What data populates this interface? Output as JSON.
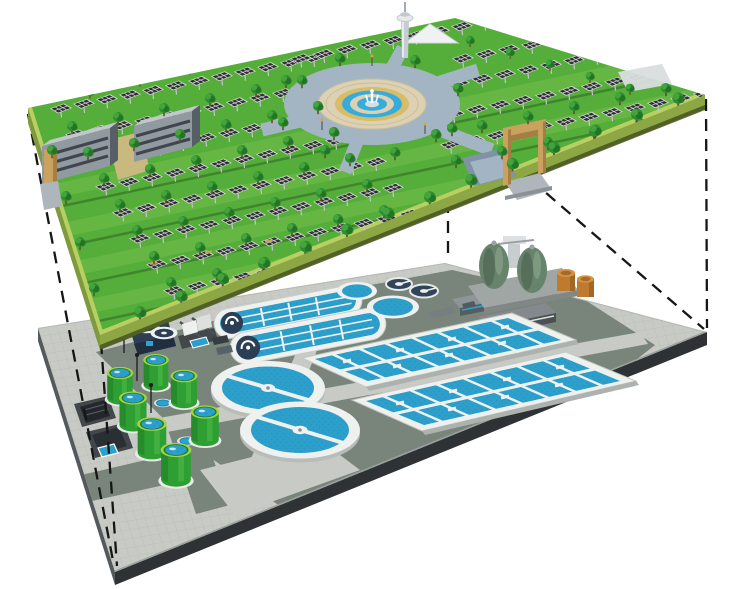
{
  "title": "Cutaway rendering: solar-panel park on the surface deck with an underground wastewater treatment plant below, linked by dashed projection lines",
  "upper_level": {
    "name": "surface park deck",
    "features": [
      "solar panel rows",
      "tree rows",
      "two office buildings",
      "central fountain plaza",
      "observation tower",
      "white pyramid pavilion",
      "tan entrance portal with ramp",
      "tan side pillar",
      "perimeter walkway band"
    ],
    "solar_panel_rows": 14,
    "buildings": 2
  },
  "lower_level": {
    "name": "underground treatment plant deck",
    "features": [
      "two circular clarifiers with bridges",
      "two aeration basin blocks",
      "two oxidation ditch racetracks",
      "two sludge digester eggs",
      "green sludge tanks",
      "two orange tanks",
      "blue blower building",
      "screening skid",
      "red pump unit",
      "service buildings",
      "open pits",
      "paved roads"
    ],
    "circular_clarifiers": 2,
    "aeration_basins": 2,
    "oxidation_ditches": 2,
    "digester_eggs": 2,
    "green_tanks": 7,
    "orange_tanks": 2
  },
  "connectors": {
    "style": "dashed",
    "count": 5,
    "color": "#161616"
  },
  "colors": {
    "bg": "#ffffff",
    "grass": "#55AE3A",
    "grassLight": "#7CC153",
    "deckSide": "#8CA743",
    "deckSideL": "#7E9A3C",
    "deckSideTop": "#B9CF61",
    "deckShadow": "#46541F",
    "tree": "#2F8C31",
    "treeDark": "#1F6E22",
    "treeLight": "#46A83F",
    "trunk": "#6B4A2A",
    "panelDark": "#2E3134",
    "panelFrame": "#DBDBD8",
    "post": "#C4C6C8",
    "building": "#9199A1",
    "buildingDark": "#565E66",
    "buildingRoof": "#C2C7CC",
    "buildingBand": "#3F464D",
    "courtyard": "#C9B97E",
    "portalTan": "#C9A25F",
    "portalTanDark": "#A57F42",
    "plazaPave": "#A3B5C2",
    "plazaDisc": "#DCD1B2",
    "plazaTan": "#D8BC6A",
    "plazaBlue": "#36ACDC",
    "towerGray": "#C6CDD2",
    "pavement": "#C8CBC5",
    "road": "#79847B",
    "deckEdgeDark": "#2E3234",
    "deckEdgeMid": "#53595C",
    "walkWhite": "#EFF1EF",
    "water": "#2D9FCB",
    "waterDark": "#1F86B4",
    "tankGreen": "#2E9F33",
    "tankDark": "#1F7A24",
    "tankLight": "#55C24E",
    "tankRim": "#A2D345",
    "navy": "#2C3E54",
    "navyDark": "#202E40",
    "egg": "#66836B",
    "eggDark": "#4C624F",
    "orange": "#BE7A2F",
    "orangeLight": "#D79244",
    "orangeDark": "#8F5A20",
    "red": "#C2391F",
    "redDark": "#8F2715",
    "equipGray": "#787F83",
    "equipDark": "#41474B",
    "dash": "#161616",
    "rampGray": "#AEB6BC",
    "rampDark": "#7E94A6",
    "baseWhite": "#E9EBE9"
  }
}
